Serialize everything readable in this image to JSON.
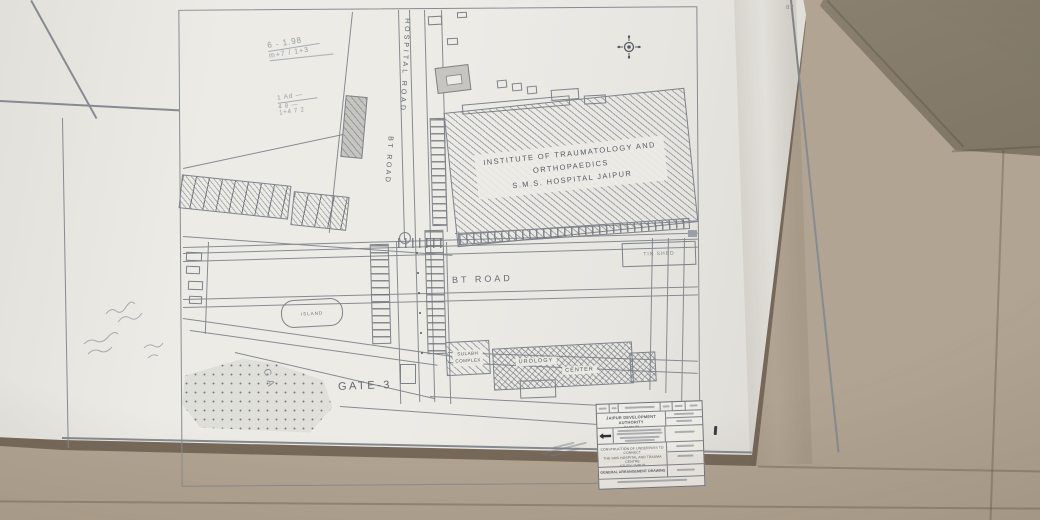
{
  "colors": {
    "floor": "#b2a492",
    "floor_dark": "#867c6b",
    "paper": "#ecebe6",
    "ink": "#7d828a",
    "pencil": "#9aa0a6"
  },
  "sheet": {
    "corner_mark": "82",
    "main_building": {
      "line1": "INSTITUTE OF TRAUMATOLOGY AND",
      "line2": "ORTHOPAEDICS",
      "line3": "S.M.S. HOSPITAL JAIPUR"
    },
    "roads": {
      "hospital_road": "HOSPITAL ROAD",
      "bt_road_v": "BT ROAD",
      "bt_road_h": "BT ROAD"
    },
    "places": {
      "gate3": "GATE-3",
      "island": "ISLAND",
      "sulabh_line1": "SULABH",
      "sulabh_line2": "COMPLEX",
      "center_line1": "UROLOGY",
      "center_line2": "CENTER",
      "tin_shed": "TIN SHED",
      "park_letters": "CA"
    },
    "pencil_notes": {
      "n1": "6 - 1.98",
      "n2": "m+7 / 1+3",
      "n3": "1 Ad —",
      "n4": "4 8 —",
      "n5": "1+4 7 2"
    },
    "title_block": {
      "authority_line1": "JAIPUR DEVELOPMENT AUTHORITY",
      "authority_line2": "JAIPUR",
      "project_line1": "CONSTRUCTION OF UNDERPASS TO CONNECT",
      "project_line2": "THE SMS HOSPITAL AND TRAUMA CENTRE",
      "project_line3": "STUDY JAIPUR",
      "drawing_title": "GENERAL ARRANGEMENT DRAWING"
    }
  }
}
